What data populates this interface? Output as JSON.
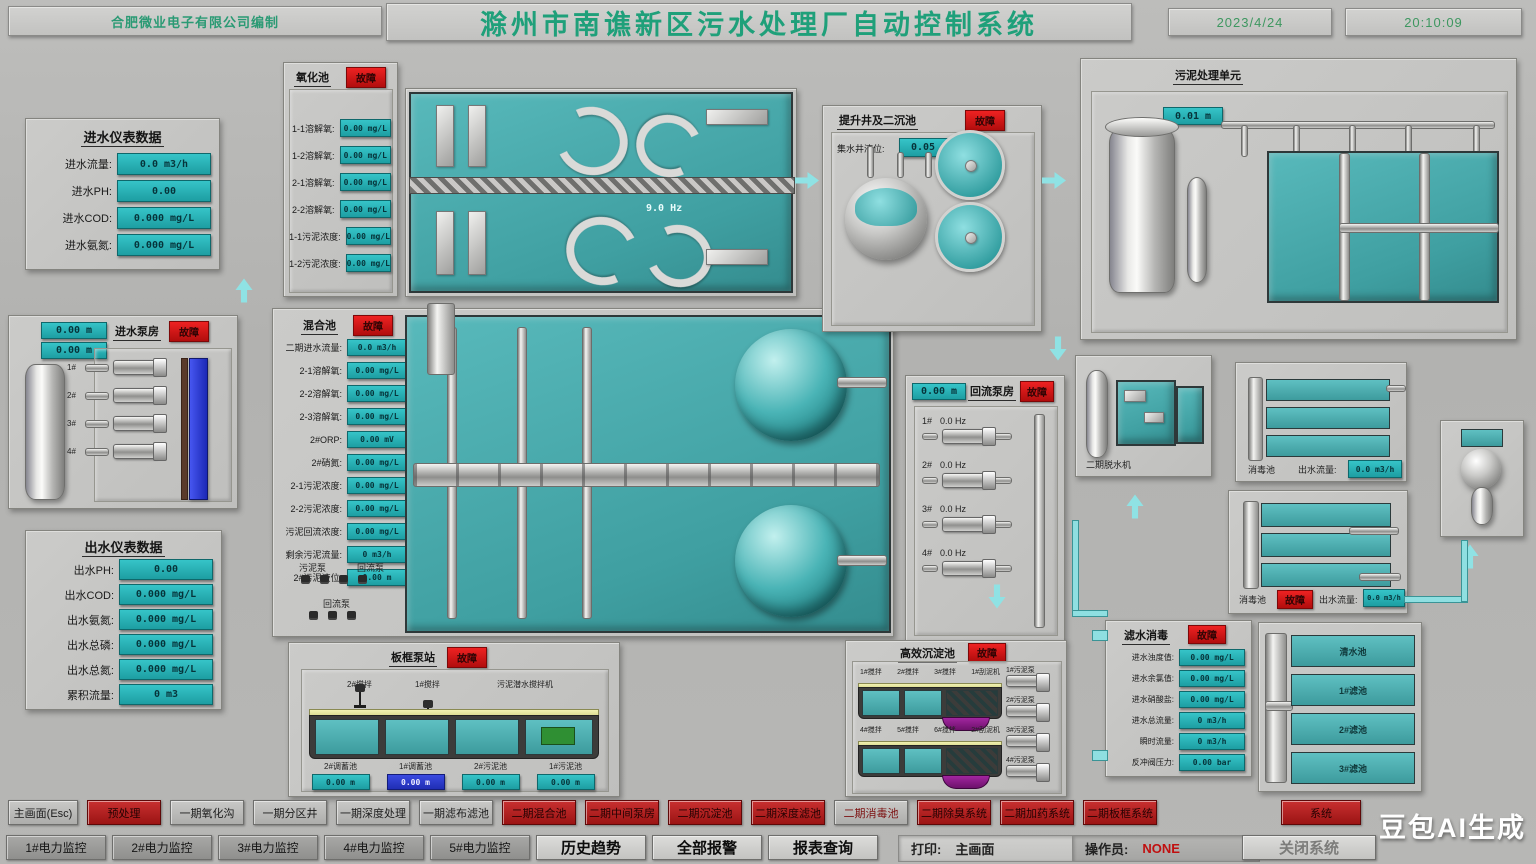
{
  "header": {
    "company": "合肥微业电子有限公司编制",
    "title": "滁州市南谯新区污水处理厂自动控制系统",
    "date": "2023/4/24",
    "time": "20:10:09"
  },
  "inflow": {
    "title": "进水仪表数据",
    "rows": [
      {
        "label": "进水流量:",
        "value": "0.0 m3/h"
      },
      {
        "label": "进水PH:",
        "value": "0.00"
      },
      {
        "label": "进水COD:",
        "value": "0.000 mg/L"
      },
      {
        "label": "进水氨氮:",
        "value": "0.000 mg/L"
      }
    ]
  },
  "inlet_pumps": {
    "title": "进水泵房",
    "status": "故障",
    "levels": [
      "0.00 m",
      "0.00 m"
    ],
    "pumps": [
      "1#",
      "2#",
      "3#",
      "4#"
    ]
  },
  "outflow": {
    "title": "出水仪表数据",
    "rows": [
      {
        "label": "出水PH:",
        "value": "0.00"
      },
      {
        "label": "出水COD:",
        "value": "0.000 mg/L"
      },
      {
        "label": "出水氨氮:",
        "value": "0.000 mg/L"
      },
      {
        "label": "出水总磷:",
        "value": "0.000 mg/L"
      },
      {
        "label": "出水总氮:",
        "value": "0.000 mg/L"
      },
      {
        "label": "累积流量:",
        "value": "0 m3"
      }
    ]
  },
  "oxidation": {
    "title": "氧化池",
    "status": "故障",
    "rows": [
      {
        "label": "1-1溶解氧:",
        "value": "0.00 mg/L"
      },
      {
        "label": "1-2溶解氧:",
        "value": "0.00 mg/L"
      },
      {
        "label": "2-1溶解氧:",
        "value": "0.00 mg/L"
      },
      {
        "label": "2-2溶解氧:",
        "value": "0.00 mg/L"
      },
      {
        "label": "1-1污泥浓度:",
        "value": "0.00 mg/L"
      },
      {
        "label": "1-2污泥浓度:",
        "value": "0.00 mg/L"
      }
    ]
  },
  "tank1": {
    "freq": "9.0 Hz"
  },
  "mixing": {
    "title": "混合池",
    "status": "故障",
    "rows": [
      {
        "label": "二期进水流量:",
        "value": "0.0 m3/h"
      },
      {
        "label": "2-1溶解氧:",
        "value": "0.00 mg/L"
      },
      {
        "label": "2-2溶解氧:",
        "value": "0.00 mg/L"
      },
      {
        "label": "2-3溶解氧:",
        "value": "0.00 mg/L"
      },
      {
        "label": "2#ORP:",
        "value": "0.00 mV"
      },
      {
        "label": "2#硝氮:",
        "value": "0.00 mg/L"
      },
      {
        "label": "2-1污泥浓度:",
        "value": "0.00 mg/L"
      },
      {
        "label": "2-2污泥浓度:",
        "value": "0.00 mg/L"
      },
      {
        "label": "污泥回流浓度:",
        "value": "0.00 mg/L"
      },
      {
        "label": "剩余污泥流量:",
        "value": "0 m3/h"
      },
      {
        "label": "2#污泥液位:",
        "value": "0.00 m"
      }
    ],
    "sub_labels": [
      "污泥泵",
      "回流泵",
      "回流泵"
    ]
  },
  "grit": {
    "title": "提升井及二沉池",
    "status": "故障",
    "level_label": "集水井液位:",
    "level_value": "0.05 m"
  },
  "sludge_unit": {
    "title": "污泥处理单元",
    "level": "0.01 m"
  },
  "return_pumps": {
    "title": "回流泵房",
    "status": "故障",
    "level": "0.00 m",
    "pumps": [
      {
        "name": "1#",
        "freq": "0.0 Hz"
      },
      {
        "name": "2#",
        "freq": "0.0 Hz"
      },
      {
        "name": "3#",
        "freq": "0.0 Hz"
      },
      {
        "name": "4#",
        "freq": "0.0 Hz"
      }
    ]
  },
  "dewatering": {
    "label": "二期脱水机"
  },
  "uv1": {
    "pool_label": "消毒池",
    "flow_label": "出水流量:",
    "flow_value": "0.0 m3/h"
  },
  "uv2": {
    "pool_label": "消毒池",
    "status": "故障",
    "flow_label": "出水流量:",
    "flow_value": "0.0 m3/h"
  },
  "frame_station": {
    "title": "板框泵站",
    "status": "故障",
    "top_labels": [
      "2#搅拌",
      "1#搅拌",
      "污泥潜水搅拌机"
    ],
    "tanks": [
      {
        "label": "2#调蓄池",
        "value": "0.00 m",
        "style": "cyan"
      },
      {
        "label": "1#调蓄池",
        "value": "0.00 m",
        "style": "blue"
      },
      {
        "label": "2#污泥池",
        "value": "0.00 m",
        "style": "cyan"
      },
      {
        "label": "1#污泥池",
        "value": "0.00 m",
        "style": "cyan"
      }
    ]
  },
  "sedimentation": {
    "title": "高效沉淀池",
    "status": "故障",
    "row1_labels": [
      "1#搅拌",
      "2#搅拌",
      "3#搅拌",
      "1#刮泥机"
    ],
    "row2_labels": [
      "4#搅拌",
      "5#搅拌",
      "6#搅拌",
      "2#刮泥机"
    ],
    "pumps": [
      "1#污泥泵",
      "2#污泥泵",
      "3#污泥泵",
      "4#污泥泵"
    ]
  },
  "filter_info": {
    "title": "滤水消毒",
    "status": "故障",
    "rows": [
      {
        "label": "进水浊度值:",
        "value": "0.00 mg/L"
      },
      {
        "label": "进水余氯值:",
        "value": "0.00 mg/L"
      },
      {
        "label": "进水硝酸盐:",
        "value": "0.00 mg/L"
      },
      {
        "label": "进水总流量:",
        "value": "0 m3/h"
      },
      {
        "label": "瞬时流量:",
        "value": "0 m3/h"
      },
      {
        "label": "反冲阀压力:",
        "value": "0.00 bar"
      }
    ]
  },
  "filter_tanks": {
    "labels": [
      "清水池",
      "1#滤池",
      "2#滤池",
      "3#滤池"
    ]
  },
  "nav": {
    "row1": [
      {
        "label": "主画面(Esc)",
        "style": "gray"
      },
      {
        "label": "预处理",
        "style": "red"
      },
      {
        "label": "一期氧化沟",
        "style": "gray"
      },
      {
        "label": "一期分区井",
        "style": "gray"
      },
      {
        "label": "一期深度处理",
        "style": "gray"
      },
      {
        "label": "一期滤布滤池",
        "style": "gray"
      },
      {
        "label": "二期混合池",
        "style": "red"
      },
      {
        "label": "二期中间泵房",
        "style": "red"
      },
      {
        "label": "二期沉淀池",
        "style": "red"
      },
      {
        "label": "二期深度滤池",
        "style": "red"
      },
      {
        "label": "二期消毒池",
        "style": "gray-red"
      },
      {
        "label": "二期除臭系统",
        "style": "red"
      },
      {
        "label": "二期加药系统",
        "style": "red"
      },
      {
        "label": "二期板框系统",
        "style": "red"
      }
    ],
    "system": {
      "label": "系统",
      "style": "red"
    },
    "row2": [
      {
        "label": "1#电力监控",
        "style": "dark"
      },
      {
        "label": "2#电力监控",
        "style": "dark"
      },
      {
        "label": "3#电力监控",
        "style": "dark"
      },
      {
        "label": "4#电力监控",
        "style": "dark"
      },
      {
        "label": "5#电力监控",
        "style": "dark"
      },
      {
        "label": "历史趋势",
        "style": "light"
      },
      {
        "label": "全部报警",
        "style": "light"
      },
      {
        "label": "报表查询",
        "style": "light"
      }
    ],
    "print_label": "打印:",
    "print_value": "主画面",
    "operator_label": "操作员:",
    "operator_value": "NONE",
    "close_label": "关闭系统"
  },
  "watermark": "豆包AI生成",
  "colors": {
    "accent_cyan": "#25b2b6",
    "alarm_red": "#d01414",
    "title_green": "#1fa07a",
    "water_teal": "#4fb0b2",
    "level_blue": "#2633d6"
  }
}
